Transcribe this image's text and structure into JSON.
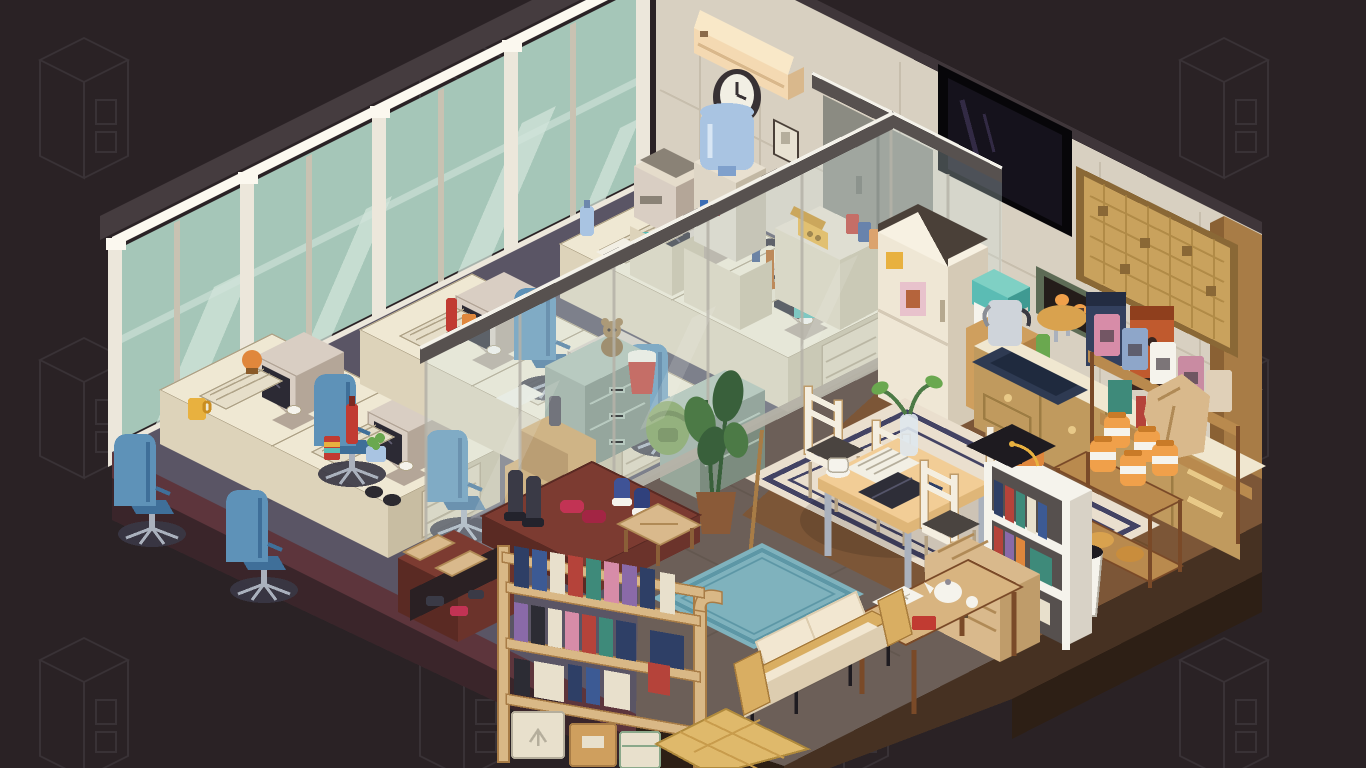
{
  "meta": {
    "app": "isometric-pixel-office-scene",
    "description": "Pixel-art isometric cutaway of a small office: glass-walled workstation area with retro CRT computers along a window wall, and a living/kitchen area with dining table, sofa, bookshelves and coffee corner, floating on a dark backdrop patterned with faint cabinet outlines.",
    "canvas": {
      "width": 1366,
      "height": 768
    }
  },
  "palette": {
    "bg": "#2a2225",
    "pattern": "#3b3438",
    "platMaroon": "#5d353c",
    "platMaroonDk": "#3a252a",
    "platBrown": "#463122",
    "platBrownDk": "#2d1f15",
    "floorOffice": "#5a5565",
    "floorOfficeLn": "#4d4858",
    "floorTile": "#6c5f58",
    "grout": "#5a4e46",
    "floorWood": "#7c5637",
    "floorWoodLn": "#674626",
    "wall": "#d8d0c1",
    "wallSeam": "#c4baa9",
    "wallTrim": "#3f363a",
    "glass": "#a5c6b8",
    "glassHi": "#d2e4da",
    "mullion": "#ece7db",
    "mullionDk": "#c9c2b2",
    "beam": "#453c3f",
    "light": "#fbf8ef",
    "partGlass": "#cfe4e6",
    "partRail": "#57514f",
    "partRailHi": "#f4f2ea",
    "partFrame": "#b5b2a8",
    "deskTop": "#efe8d3",
    "deskFront": "#ddd3ba",
    "deskSide": "#c8bda2",
    "deskLine": "#b0a489",
    "crt": "#d9cec3",
    "crtShade": "#b4a698",
    "screen": "#2c2a34",
    "chair": "#5e92b8",
    "chairDk": "#3f6f99",
    "chairMat": "#3a3744",
    "metal": "#aab1bd",
    "cabinet": "#97a79a",
    "cabinetDk": "#7c8c7f",
    "cabinetTop": "#aebfb1",
    "fridge": "#efe7d5",
    "fridgeSide": "#d5cab6",
    "counterTop": "#f0e7d0",
    "counterWood": "#c09a5e",
    "counterWoodDk": "#9d7c43",
    "knob": "#e8c988",
    "sink": "#2e3a52",
    "sinkDk": "#1f2a3e",
    "tv": "#15121c",
    "tvGlow": "#322a44",
    "tvFrame": "#070609",
    "pegboard": "#c9a25d",
    "pegHole": "#a8823f",
    "pegFrame": "#8a6836",
    "column": "#a87c46",
    "columnDk": "#8a6134",
    "door": "#8b8b82",
    "doorDk": "#6f7068",
    "rug": "#eadfce",
    "rugBorder": "#434364",
    "rugBlue": "#7fb2bd",
    "rugBlueDk": "#5d97a6",
    "sofa": "#f2e7d1",
    "sofaShade": "#ddcdb0",
    "sofaWood": "#d9ae62",
    "woodLight": "#d8b480",
    "woodMid": "#b98a4e",
    "woodDark": "#7a4a28",
    "shelfWood": "#d9b886",
    "shoeRack": "#7c3b31",
    "shoeRackDk": "#5a2a23",
    "bookRed": "#b5433a",
    "bookBlue": "#3c5a94",
    "bookTeal": "#3e8a7a",
    "bookPink": "#d78ca8",
    "bookPurple": "#8a6aa8",
    "bookNavy": "#2e3f66",
    "bookCream": "#e8e0cc",
    "bookBlack": "#2c2c34",
    "orange": "#e0873c",
    "orangeDk": "#b5641f",
    "red": "#c13b32",
    "yellow": "#e8b13f",
    "honey": "#f0a04a",
    "honeyDk": "#c97b28",
    "green": "#6aa84f",
    "plantGreen": "#4c7a46",
    "plantDark": "#39603b",
    "pot": "#8a5a38",
    "waterBlue": "#a9c4e2",
    "waterBlueDk": "#7fa0cc",
    "teal": "#5bbcb4",
    "navy": "#33405e",
    "navyDk": "#232c42",
    "cream": "#f4eee0",
    "tan": "#d9b98c",
    "tanDk": "#bf9c6a",
    "cardboard": "#cf9f5e",
    "cardboardDk": "#b08044",
    "white": "#f5f3ec",
    "black": "#1e1b20",
    "gray": "#8e8a94",
    "paper": "#f2efe4",
    "kettle": "#cfd4da",
    "machineOrange": "#c05a2e",
    "machineOrangeDk": "#8f3f1d"
  },
  "scene": {
    "rooms": [
      {
        "id": "office",
        "label": "glass-walled office with six workstations"
      },
      {
        "id": "living-kitchen",
        "label": "break room with dining set, sofa and coffee corner"
      }
    ],
    "objects": [
      {
        "id": "window-wall",
        "label": "floor-to-ceiling windows with light strip",
        "count": 1
      },
      {
        "id": "glass-partition",
        "label": "interior glass partition walls",
        "count": 2
      },
      {
        "id": "desk-workstation",
        "label": "beige desk with CRT computer, keyboard, mouse and blue office chair",
        "count": 6
      },
      {
        "id": "filing-cabinet",
        "label": "green metal filing cabinets",
        "count": 2
      },
      {
        "id": "moving-boxes",
        "label": "stacked cardboard boxes",
        "count": 2
      },
      {
        "id": "water-cooler",
        "label": "water cooler with blue bottle",
        "count": 1
      },
      {
        "id": "copier",
        "label": "office copier on stand",
        "count": 1
      },
      {
        "id": "telephone",
        "label": "yellow desk telephone on low cabinet",
        "count": 1
      },
      {
        "id": "snack-bags",
        "label": "snack bags on cabinet",
        "count": 3
      },
      {
        "id": "teddy-bear",
        "label": "teddy bear on filing cabinet",
        "count": 1
      },
      {
        "id": "noodle-cup",
        "label": "instant noodle cup",
        "count": 1
      },
      {
        "id": "backpack",
        "label": "green backpack",
        "count": 1
      },
      {
        "id": "ac-unit",
        "label": "wall air conditioner",
        "count": 1
      },
      {
        "id": "wall-clock",
        "label": "round wall clock",
        "count": 1
      },
      {
        "id": "light-switch",
        "label": "wall switch panel",
        "count": 1
      },
      {
        "id": "sliding-door",
        "label": "gray wall door",
        "count": 1
      },
      {
        "id": "tv",
        "label": "wall-mounted flat TV",
        "count": 1
      },
      {
        "id": "pegboard",
        "label": "wooden pegboard panel",
        "count": 1
      },
      {
        "id": "wall-oven-art",
        "label": "green-framed glowing wall box",
        "count": 1
      },
      {
        "id": "fridge",
        "label": "cream refrigerator with notes",
        "count": 1
      },
      {
        "id": "cooler-box",
        "label": "teal cooler on boxes",
        "count": 1
      },
      {
        "id": "kitchen-counter",
        "label": "wooden kitchen counter with sink, kettle, bread and coffee machines",
        "count": 1
      },
      {
        "id": "coffee-bag-rack",
        "label": "shelf of coffee bags",
        "count": 1
      },
      {
        "id": "honey-cart",
        "label": "cart with honey jars and paper bag",
        "count": 1
      },
      {
        "id": "trash-bin",
        "label": "white trash bin",
        "count": 1
      },
      {
        "id": "dining-table",
        "label": "dining table with laptop, newspaper, cup and vase",
        "count": 1
      },
      {
        "id": "dining-chair",
        "label": "cream ladder-back chair",
        "count": 4
      },
      {
        "id": "area-rug",
        "label": "cream rug with navy border",
        "count": 1
      },
      {
        "id": "small-bookshelf",
        "label": "white bookshelf with graduation cap and lunchbox",
        "count": 1
      },
      {
        "id": "storage-chest",
        "label": "wicker storage chest",
        "count": 1
      },
      {
        "id": "console-table",
        "label": "console table with open book and teapot",
        "count": 1
      },
      {
        "id": "sofa",
        "label": "wood-frame sofa with cream cushions",
        "count": 1
      },
      {
        "id": "blue-rug",
        "label": "teal runner rug",
        "count": 1
      },
      {
        "id": "floor-plant",
        "label": "tall potted plant",
        "count": 1
      },
      {
        "id": "broom",
        "label": "broom leaning by plant",
        "count": 1
      },
      {
        "id": "wood-bench",
        "label": "small wooden bench",
        "count": 1
      },
      {
        "id": "shoe-rack",
        "label": "entry shoe rack with boots and sneakers",
        "count": 1
      },
      {
        "id": "entry-bench",
        "label": "cushioned entry bench with shoes below",
        "count": 1
      },
      {
        "id": "tall-bookshelf",
        "label": "arched wooden bookshelf with books and storage boxes",
        "count": 1
      },
      {
        "id": "tatami-mat",
        "label": "woven floor mat",
        "count": 1
      }
    ]
  }
}
